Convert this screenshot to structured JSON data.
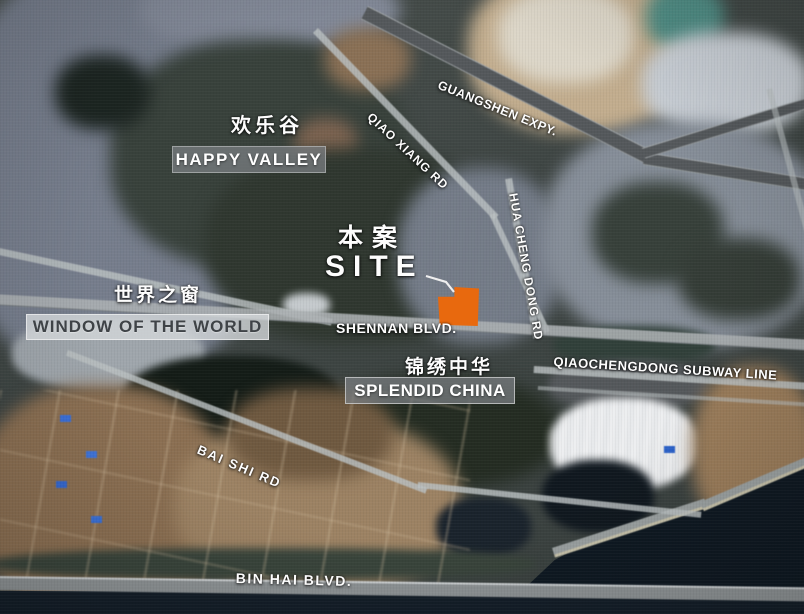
{
  "map": {
    "site": {
      "label_zh": "本案",
      "label_en": "SITE",
      "marker_color": "#e8690e"
    },
    "landmarks": {
      "happy_valley": {
        "zh": "欢乐谷",
        "en": "HAPPY VALLEY"
      },
      "window_of_the_world": {
        "zh": "世界之窗",
        "en": "WINDOW OF THE WORLD"
      },
      "splendid_china": {
        "zh": "锦绣中华",
        "en": "SPLENDID CHINA"
      }
    },
    "roads": {
      "guangshen_expy": "GUANGSHEN EXPY.",
      "qiao_xiang_rd": "QIAO XIANG RD",
      "hua_cheng_dong_rd": "HUA CHENG DONG RD",
      "shennan_blvd": "SHENNAN BLVD.",
      "qiaochengdong_subway_line": "QIAOCHENGDONG SUBWAY LINE",
      "bai_shi_rd": "BAI SHI RD",
      "bin_hai_blvd": "BIN HAI BLVD."
    }
  }
}
